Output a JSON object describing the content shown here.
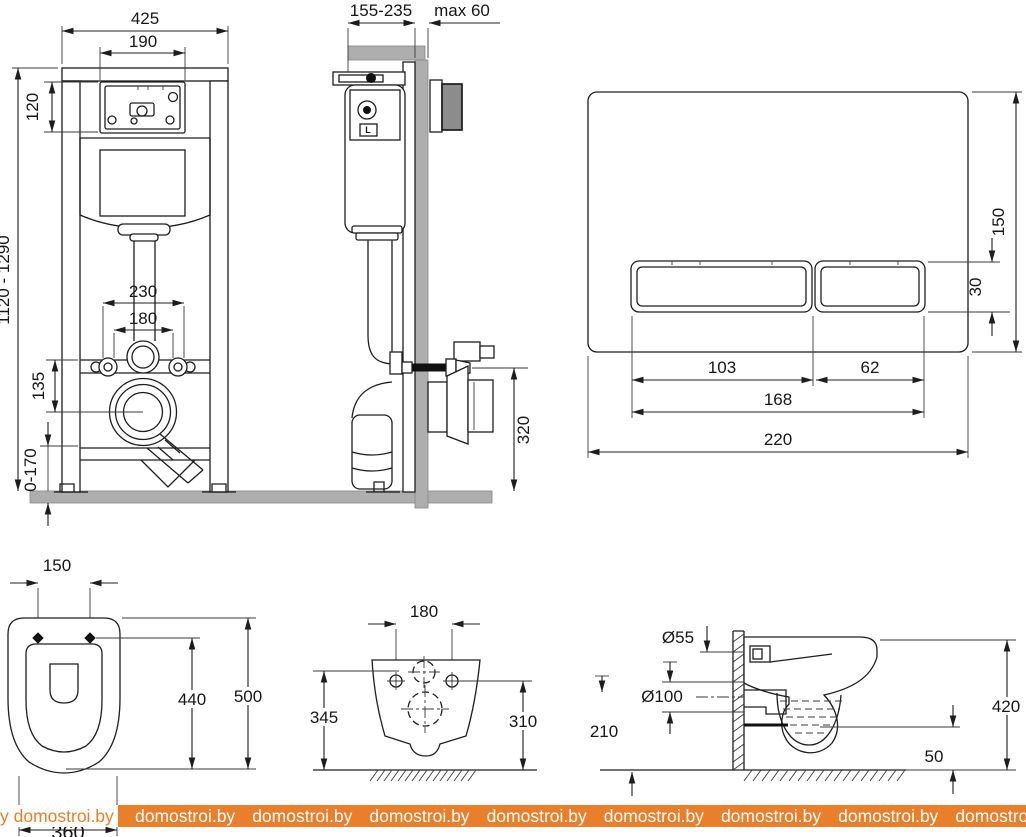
{
  "colors": {
    "line": "#1d1d1d",
    "gray_fill": "#aeaeae",
    "watermark_orange": "#EA7F2B",
    "background": "#ffffff"
  },
  "watermark": {
    "left": "y domostroi.by",
    "tile": "domostroi.by"
  },
  "frame_front": {
    "dim_total_width": "425",
    "dim_opening_width": "190",
    "dim_opening_height": "120",
    "dim_height_range": "1120 - 1290",
    "dim_rod_spacing_outer": "230",
    "dim_rod_spacing_inner": "180",
    "dim_outlet_drop": "135",
    "dim_leg_range": "0-170"
  },
  "frame_side": {
    "dim_depth_range": "155-235",
    "dim_wall_max": "max 60",
    "dim_outlet_height": "320",
    "valve_label": "L"
  },
  "flush_plate": {
    "dim_height": "150",
    "dim_button_height": "30",
    "dim_big_button_width": "103",
    "dim_small_button_width": "62",
    "dim_buttons_width": "168",
    "dim_width": "220"
  },
  "bowl_front": {
    "dim_hole_spacing": "150",
    "dim_inner_depth": "440",
    "dim_total_depth": "500",
    "dim_width": "360"
  },
  "bowl_rear": {
    "dim_hole_spacing": "180",
    "dim_height_left": "345",
    "dim_height_right": "310"
  },
  "bowl_side": {
    "dim_inlet_diameter": "Ø55",
    "dim_outlet_diameter": "Ø100",
    "dim_outlet_axis_height": "210",
    "dim_total_height": "420",
    "dim_floor_clearance": "50"
  }
}
